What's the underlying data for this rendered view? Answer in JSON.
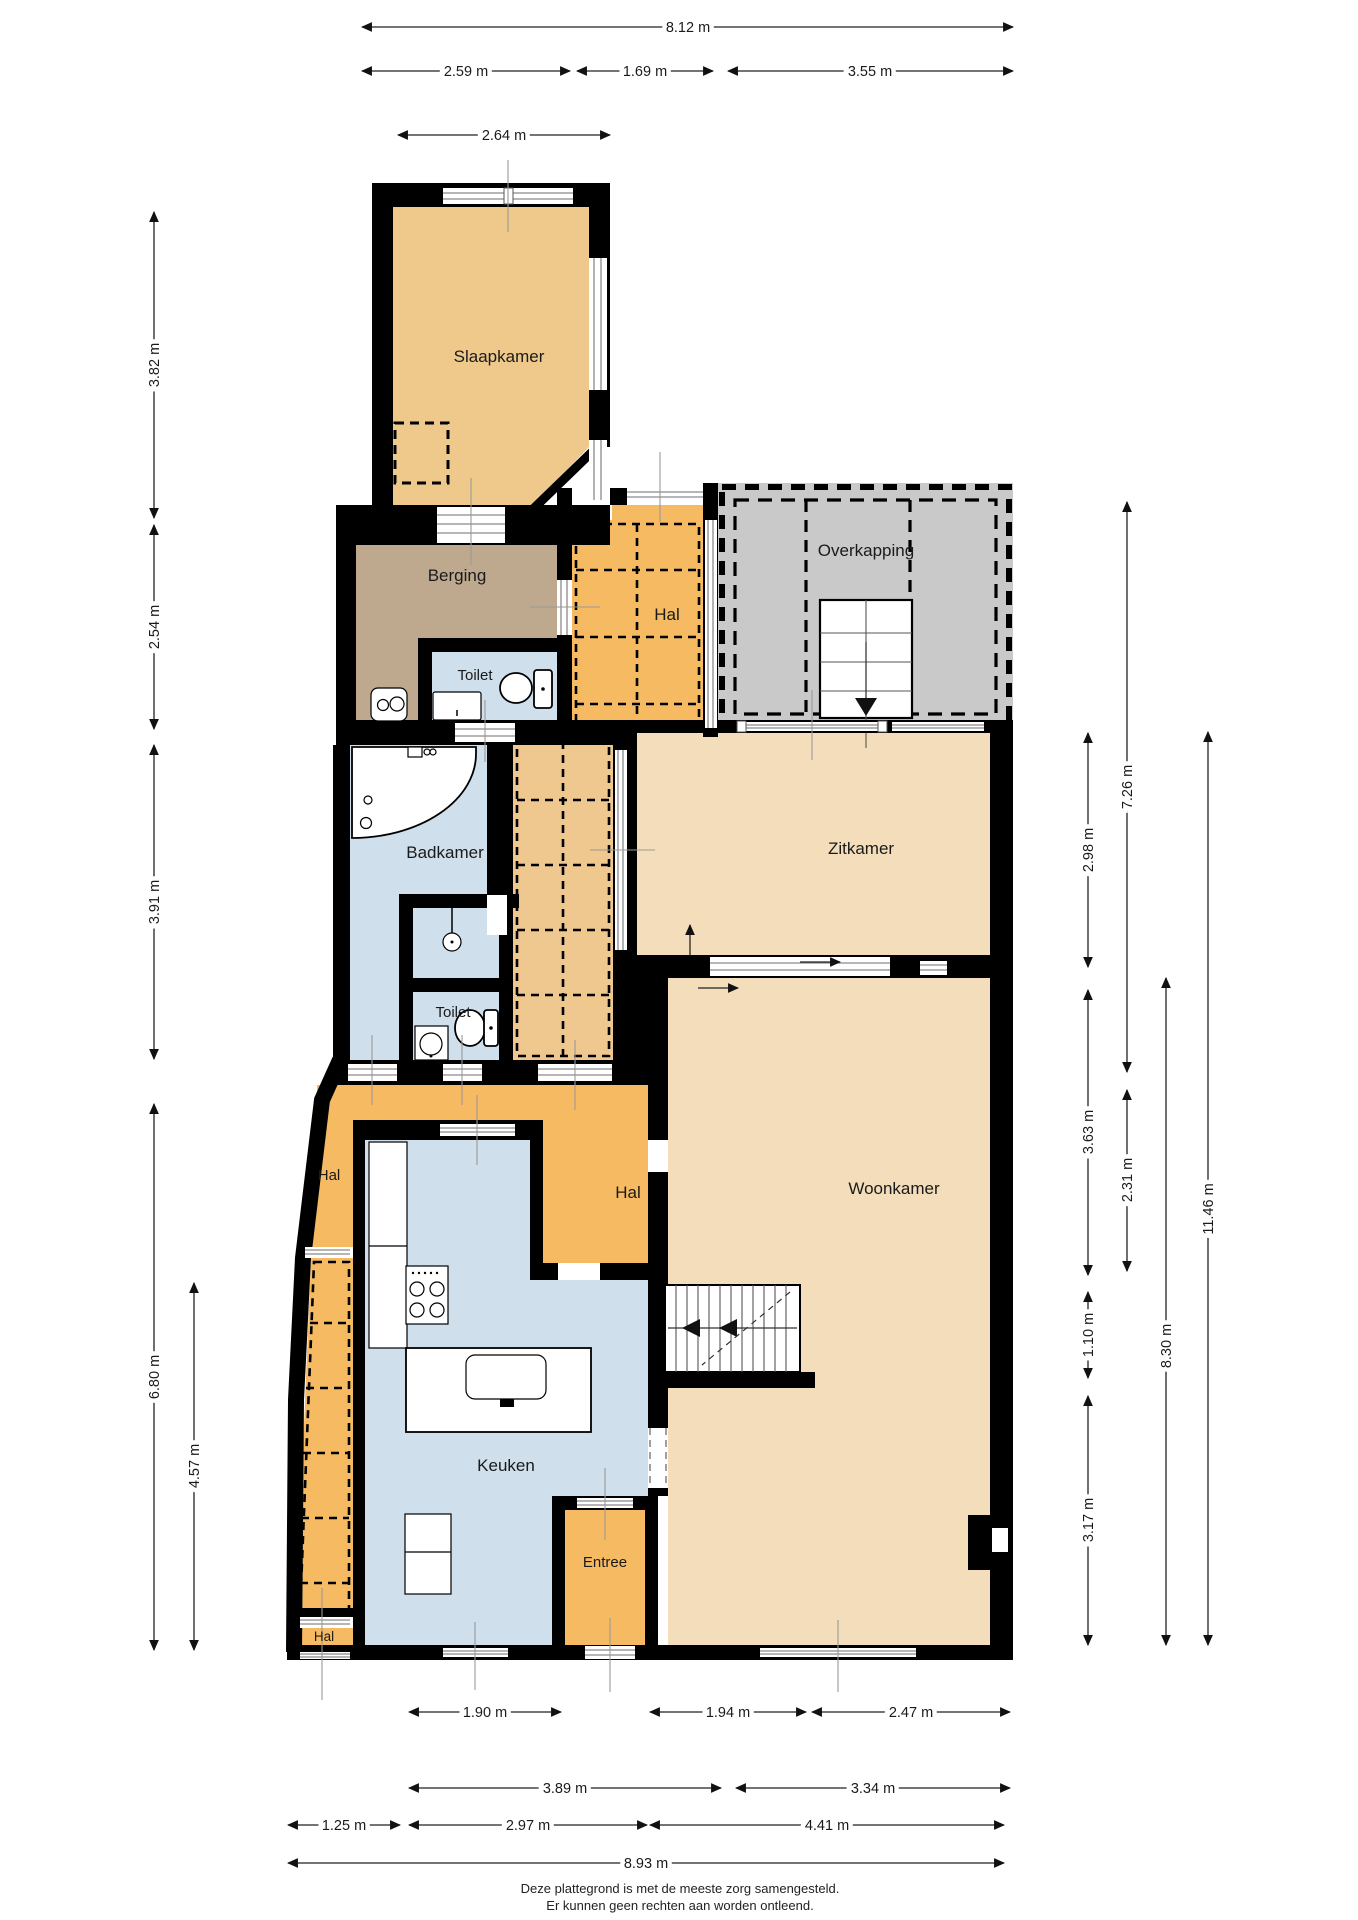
{
  "rooms": {
    "slaapkamer": "Slaapkamer",
    "berging": "Berging",
    "toilet_boven": "Toilet",
    "hal_boven": "Hal",
    "overkapping": "Overkapping",
    "badkamer": "Badkamer",
    "toilet_onder": "Toilet",
    "zitkamer": "Zitkamer",
    "hal_links": "Hal",
    "hal_midden": "Hal",
    "woonkamer": "Woonkamer",
    "keuken": "Keuken",
    "entree": "Entree",
    "hal_onder": "Hal"
  },
  "dimensions": {
    "top": [
      "8.12 m",
      "2.59 m",
      "1.69 m",
      "3.55 m",
      "2.64 m"
    ],
    "left": [
      "3.82 m",
      "2.54 m",
      "3.91 m",
      "6.80 m",
      "4.57 m"
    ],
    "right": [
      "7.26 m",
      "2.98 m",
      "3.63 m",
      "2.31 m",
      "1.10 m",
      "3.17 m",
      "8.30 m",
      "11.46 m"
    ],
    "bottom": [
      "1.90 m",
      "1.94 m",
      "2.47 m",
      "3.89 m",
      "3.34 m",
      "1.25 m",
      "2.97 m",
      "4.41 m",
      "8.93 m"
    ]
  },
  "footer": {
    "line1": "Deze plattegrond is met de meeste zorg samengesteld.",
    "line2": "Er kunnen geen rechten aan worden ontleend."
  },
  "colors": {
    "wall": "#000000",
    "room_beige": "#f3ddba",
    "room_orange": "#f6ba62",
    "room_orange_light": "#eec88e",
    "room_slaapkamer": "#efc98b",
    "room_berging": "#bfa98e",
    "room_blue": "#cfdfeb",
    "overkapping_gray": "#c9c9c9",
    "window_line": "#8a8a8a"
  }
}
